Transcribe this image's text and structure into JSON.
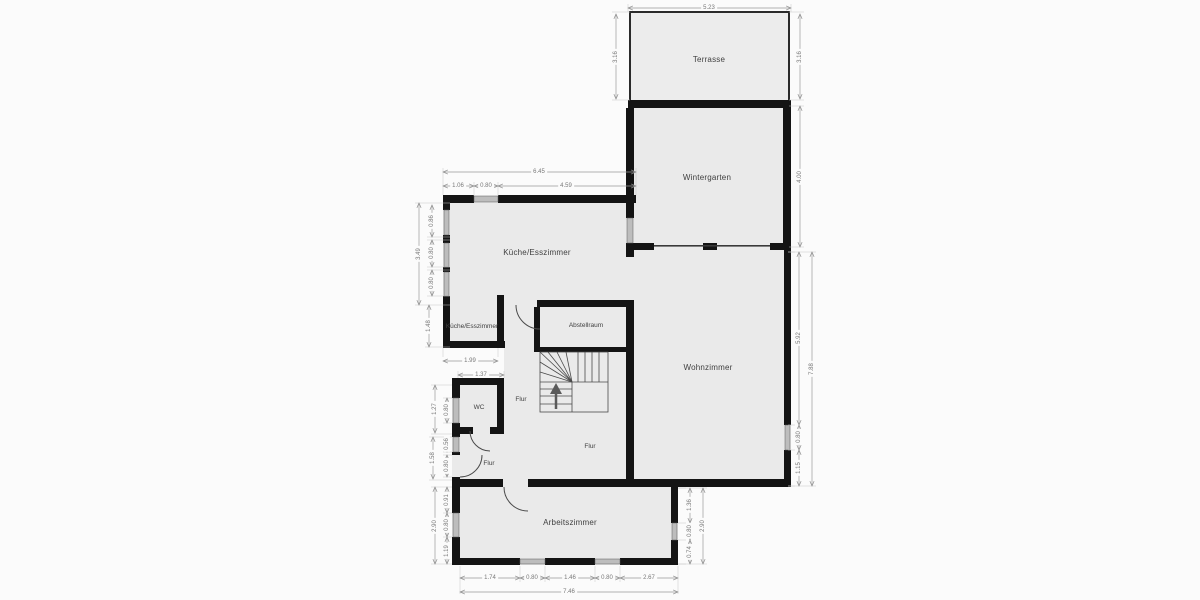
{
  "plan": {
    "title": "floor-plan",
    "colors": {
      "background": "#fbfbfb",
      "room_fill": "#eaeaea",
      "wall": "#141414",
      "window": "#bdbdbd",
      "dim_line": "#9a9a9a",
      "dim_text": "#787878",
      "room_text": "#3f3f3f"
    }
  },
  "rooms": {
    "terrasse": "Terrasse",
    "wintergarten": "Wintergarten",
    "kueche": "Küche/Esszimmer",
    "kueche2": "Küche/Esszimmer",
    "abstellraum": "Abstellraum",
    "wohnzimmer": "Wohnzimmer",
    "wc": "WC",
    "flur1": "Flur",
    "flur2": "Flur",
    "flur3": "Flur",
    "arbeitszimmer": "Arbeitszimmer"
  },
  "icons": {
    "stairs_arrow": "stairs-up-arrow"
  },
  "dims": [
    {
      "v": "5.23",
      "x": 709,
      "y": 8,
      "o": "h"
    },
    {
      "v": "3.16",
      "x": 616,
      "y": 57,
      "o": "v"
    },
    {
      "v": "3.16",
      "x": 800,
      "y": 57,
      "o": "v"
    },
    {
      "v": "4.00",
      "x": 800,
      "y": 177,
      "o": "v"
    },
    {
      "v": "6.45",
      "x": 539,
      "y": 172,
      "o": "h"
    },
    {
      "v": "1.06",
      "x": 458,
      "y": 186,
      "o": "h"
    },
    {
      "v": "0.80",
      "x": 486,
      "y": 186,
      "o": "h"
    },
    {
      "v": "4.59",
      "x": 566,
      "y": 186,
      "o": "h"
    },
    {
      "v": "3.49",
      "x": 419,
      "y": 254,
      "o": "v"
    },
    {
      "v": "0.86",
      "x": 432,
      "y": 221,
      "o": "v"
    },
    {
      "v": "0.80",
      "x": 432,
      "y": 253,
      "o": "v"
    },
    {
      "v": "0.80",
      "x": 432,
      "y": 283,
      "o": "v"
    },
    {
      "v": "1.48",
      "x": 429,
      "y": 326,
      "o": "v"
    },
    {
      "v": "1.99",
      "x": 470,
      "y": 361,
      "o": "h"
    },
    {
      "v": "1.37",
      "x": 481,
      "y": 375,
      "o": "h"
    },
    {
      "v": "1.27",
      "x": 435,
      "y": 409,
      "o": "v"
    },
    {
      "v": "0.80",
      "x": 447,
      "y": 410,
      "o": "v"
    },
    {
      "v": "1.58",
      "x": 433,
      "y": 458,
      "o": "v"
    },
    {
      "v": "0.56",
      "x": 447,
      "y": 444,
      "o": "v"
    },
    {
      "v": "0.80",
      "x": 447,
      "y": 466,
      "o": "v"
    },
    {
      "v": "2.90",
      "x": 435,
      "y": 526,
      "o": "v"
    },
    {
      "v": "0.91",
      "x": 447,
      "y": 500,
      "o": "v"
    },
    {
      "v": "0.80",
      "x": 447,
      "y": 525,
      "o": "v"
    },
    {
      "v": "1.19",
      "x": 447,
      "y": 551,
      "o": "v"
    },
    {
      "v": "5.92",
      "x": 799,
      "y": 338,
      "o": "v"
    },
    {
      "v": "7.88",
      "x": 812,
      "y": 369,
      "o": "v"
    },
    {
      "v": "0.80",
      "x": 799,
      "y": 437,
      "o": "v"
    },
    {
      "v": "1.15",
      "x": 799,
      "y": 468,
      "o": "v"
    },
    {
      "v": "1.36",
      "x": 690,
      "y": 505,
      "o": "v"
    },
    {
      "v": "0.80",
      "x": 690,
      "y": 531,
      "o": "v"
    },
    {
      "v": "0.74",
      "x": 690,
      "y": 552,
      "o": "v"
    },
    {
      "v": "2.90",
      "x": 703,
      "y": 526,
      "o": "v"
    },
    {
      "v": "1.74",
      "x": 490,
      "y": 578,
      "o": "h"
    },
    {
      "v": "0.80",
      "x": 532,
      "y": 578,
      "o": "h"
    },
    {
      "v": "1.46",
      "x": 570,
      "y": 578,
      "o": "h"
    },
    {
      "v": "0.80",
      "x": 607,
      "y": 578,
      "o": "h"
    },
    {
      "v": "2.67",
      "x": 649,
      "y": 578,
      "o": "h"
    },
    {
      "v": "7.46",
      "x": 569,
      "y": 592,
      "o": "h"
    }
  ]
}
